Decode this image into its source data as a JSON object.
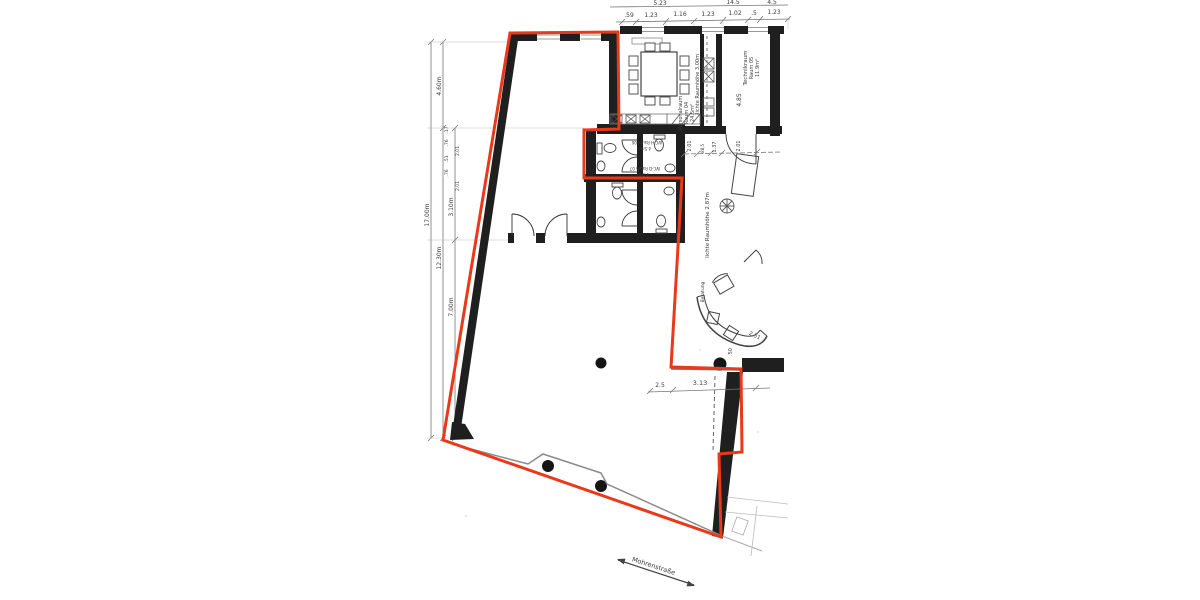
{
  "plan": {
    "title": "floor-plan-scan",
    "colors": {
      "outline_red": "#e8391a",
      "wall_black": "#1f1f1f",
      "line_gray": "#8a8a8a"
    }
  },
  "street": {
    "label": "Mohrenstraße"
  },
  "top_dims": {
    "upper": [
      "5.23",
      "14.5",
      "4.5"
    ],
    "chain": [
      ".59",
      "1.23",
      "1.16",
      "1.23",
      "1.02",
      ".5",
      "1.23"
    ]
  },
  "left_dims": {
    "overall": "17.00m",
    "upper": "4.60m",
    "lower": "12.30m",
    "mid_upper": "3.10m",
    "mid_lower": "7.00m",
    "detail": [
      ".17",
      ".76",
      ".51",
      ".76",
      "2.01",
      "2.01"
    ]
  },
  "rooms": {
    "technikraum": {
      "name": "Technikraum",
      "number": "Raum 05",
      "area": "11.9m²"
    },
    "personalraum": {
      "name": "Personalraum",
      "number": "Raum 04",
      "area": "24.5m²"
    },
    "wc_h": {
      "name": "WC-H Raum 06",
      "area": "4.5m²"
    },
    "wc_d": {
      "name": "WC-D Raum 07",
      "area": "4.5m²"
    },
    "kitchen_height": "lichte Raumhöhe 3.00m",
    "hall_height": "lichte Raumhöhe 2.87m",
    "beratung": "Beratung"
  },
  "inner_dims": {
    "door_chain": [
      "2.01",
      ".88,5",
      "1.37",
      "2.01"
    ],
    "right_height": "4.85",
    "bottom_small": "2.5",
    "bottom_main": "3.13",
    "column_offset": ".50",
    "diagonal": "2.51"
  }
}
